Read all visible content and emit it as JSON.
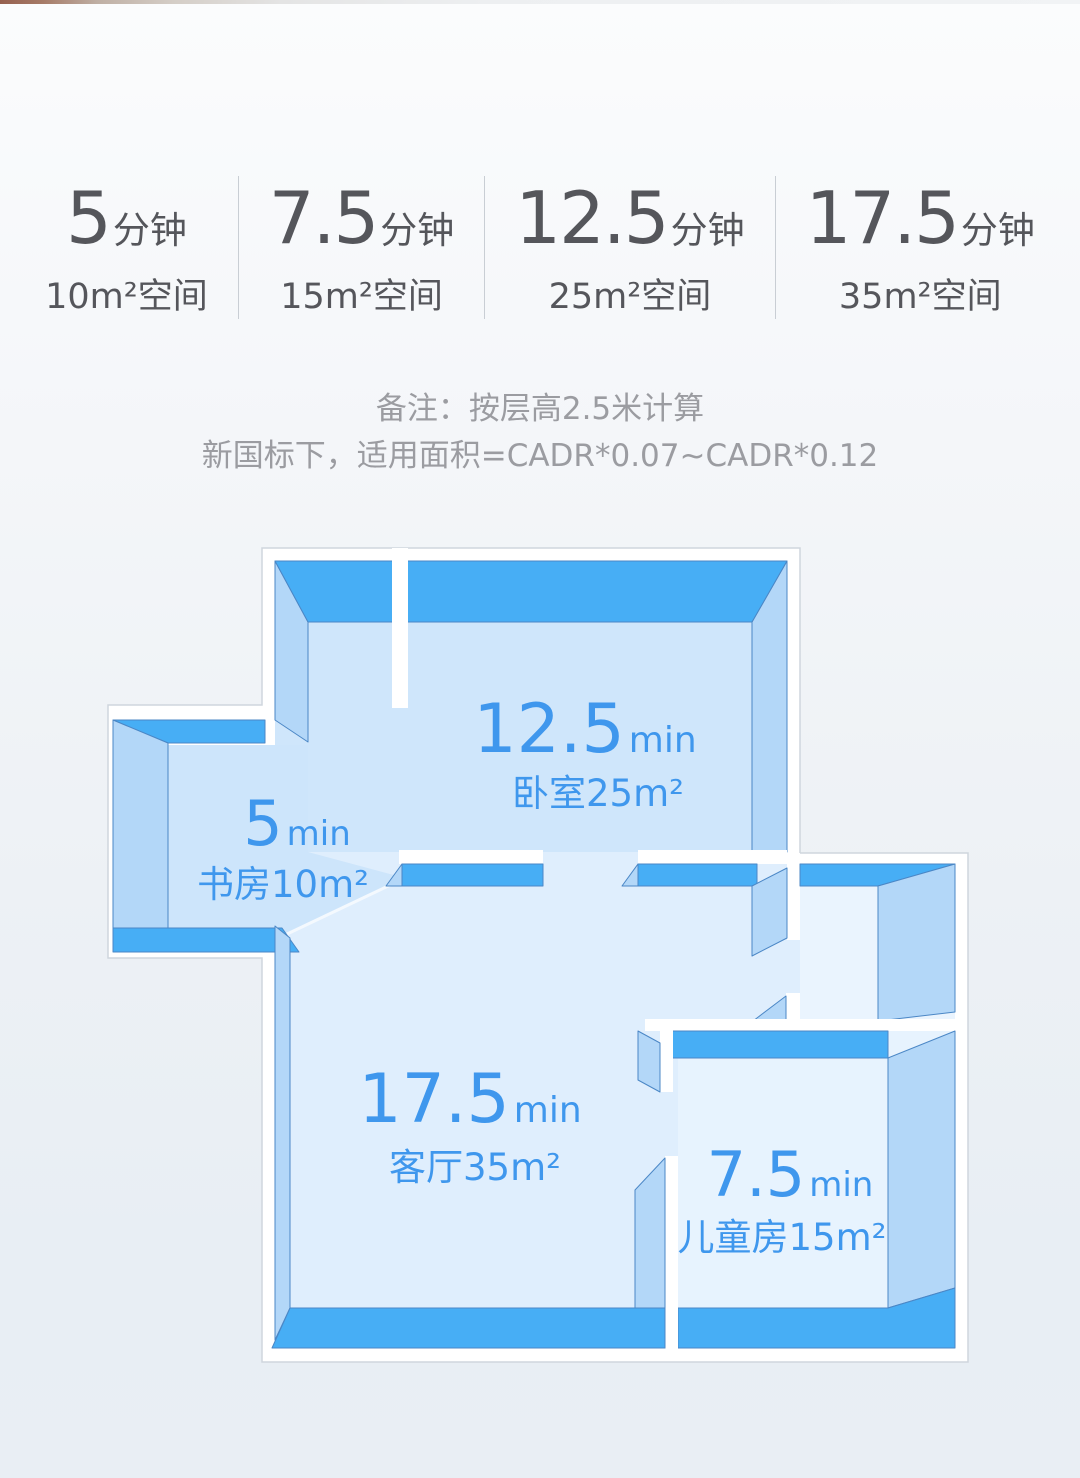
{
  "stats": {
    "items": [
      {
        "minutes": "5",
        "unit": "分钟",
        "area": "10m²空间"
      },
      {
        "minutes": "7.5",
        "unit": "分钟",
        "area": "15m²空间"
      },
      {
        "minutes": "12.5",
        "unit": "分钟",
        "area": "25m²空间"
      },
      {
        "minutes": "17.5",
        "unit": "分钟",
        "area": "35m²空间"
      }
    ]
  },
  "note": {
    "line1": "备注：按层高2.5米计算",
    "line2": "新国标下，适用面积=CADR*0.07~CADR*0.12"
  },
  "floorplan": {
    "rooms": [
      {
        "id": "bedroom",
        "time": "12.5",
        "time_unit": "min",
        "label": "卧室25m²"
      },
      {
        "id": "study",
        "time": "5",
        "time_unit": "min",
        "label": "书房10m²"
      },
      {
        "id": "living",
        "time": "17.5",
        "time_unit": "min",
        "label": "客厅35m²"
      },
      {
        "id": "kids",
        "time": "7.5",
        "time_unit": "min",
        "label": "儿童房15m²"
      }
    ],
    "colors": {
      "wall_top": "#47aef5",
      "wall_side": "#b3d7f8",
      "floor_bedroom": "#cfe6fb",
      "floor_study": "#cde5fb",
      "floor_living": "#dfeefd",
      "floor_kids": "#e7f3fe",
      "floor_hall": "#eaf4fe",
      "label_text": "#3f97ed",
      "outline": "#cfd6dd",
      "stats_text": "#55565b",
      "note_text": "#9b9ca1"
    }
  }
}
